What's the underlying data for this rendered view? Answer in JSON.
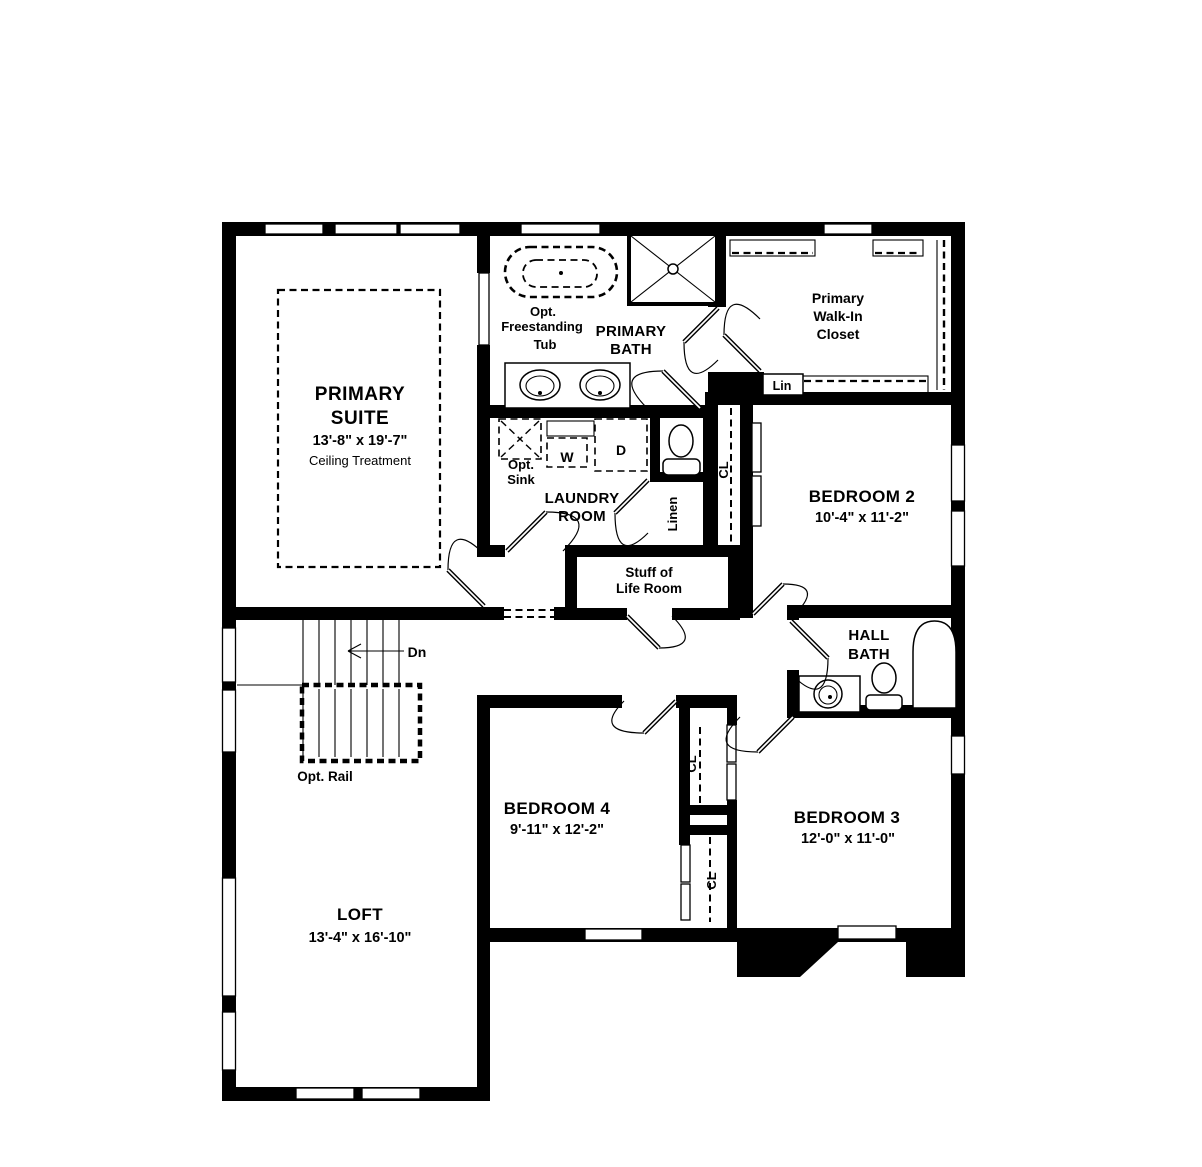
{
  "plan": {
    "type": "second-floor residential floor plan",
    "colors": {
      "wall": "#000000",
      "background": "#ffffff"
    },
    "rooms": {
      "primary_suite": {
        "line1": "PRIMARY",
        "line2": "SUITE",
        "dims": "13'-8\" x 19'-7\"",
        "note": "Ceiling Treatment"
      },
      "primary_bath": {
        "line1": "PRIMARY",
        "line2": "BATH"
      },
      "opt_tub": {
        "line1": "Opt.",
        "line2": "Freestanding",
        "line3": "Tub"
      },
      "walk_in_closet": {
        "line1": "Primary",
        "line2": "Walk-In",
        "line3": "Closet"
      },
      "laundry": {
        "line1": "LAUNDRY",
        "line2": "ROOM"
      },
      "stuff_of_life": {
        "line1": "Stuff of",
        "line2": "Life Room"
      },
      "hall_bath": {
        "line1": "HALL",
        "line2": "BATH"
      },
      "bedroom2": {
        "name": "BEDROOM 2",
        "dims": "10'-4\" x 11'-2\""
      },
      "bedroom3": {
        "name": "BEDROOM 3",
        "dims": "12'-0\" x 11'-0\""
      },
      "bedroom4": {
        "name": "BEDROOM 4",
        "dims": "9'-11\" x 12'-2\""
      },
      "loft": {
        "name": "LOFT",
        "dims": "13'-4\" x 16'-10\""
      }
    },
    "labels": {
      "lin": "Lin",
      "linen": "Linen",
      "closet": "CL",
      "washer": "W",
      "dryer": "D",
      "opt_sink_line1": "Opt.",
      "opt_sink_line2": "Sink",
      "down": "Dn",
      "opt_rail": "Opt. Rail"
    }
  }
}
